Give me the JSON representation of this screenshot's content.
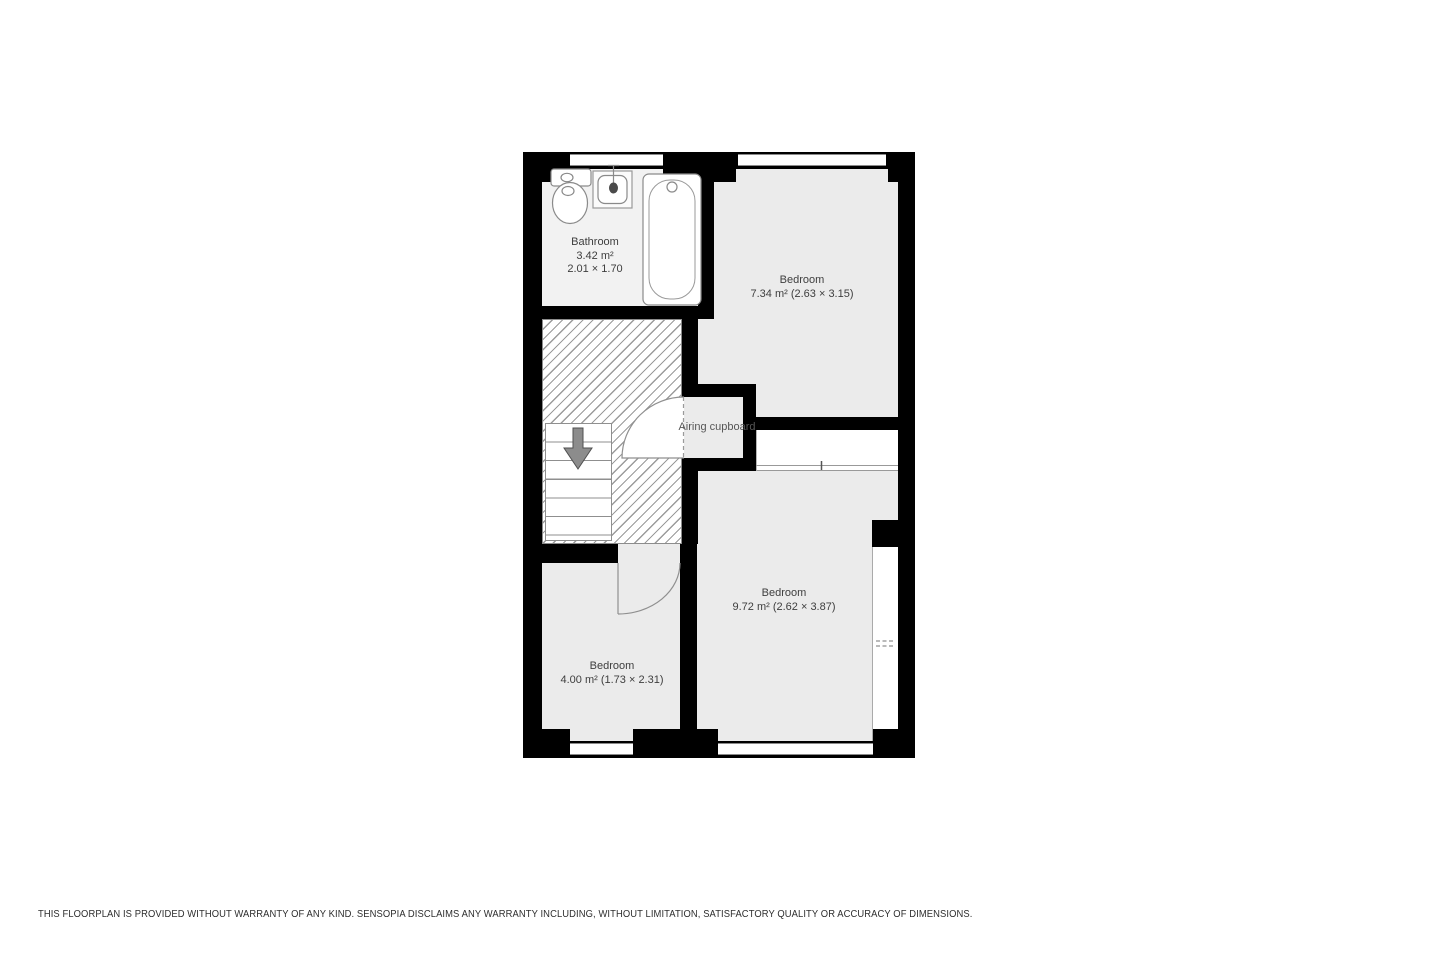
{
  "floorplan": {
    "rooms": {
      "bathroom": {
        "name": "Bathroom",
        "area": "3.42 m²",
        "dims": "2.01 × 1.70"
      },
      "bedroom_top": {
        "name": "Bedroom",
        "details": "7.34 m² (2.63 × 3.15)"
      },
      "bedroom_right": {
        "name": "Bedroom",
        "details": "9.72 m² (2.62 × 3.87)"
      },
      "bedroom_left": {
        "name": "Bedroom",
        "details": "4.00 m² (1.73 × 2.31)"
      },
      "airing_cupboard": {
        "name": "Airing cupboard"
      }
    },
    "fixtures": [
      "toilet",
      "sink",
      "bathtub",
      "staircase-down-arrow"
    ],
    "colors": {
      "wall": "#000000",
      "room_fill": "#ebebeb",
      "bathroom_fill": "#f2f2f2",
      "hatch_line": "#9b9b9b",
      "label_text": "#3e3e3e",
      "fixture_outline": "#8a8a8a",
      "stairs_arrow": "#8c8c8c"
    }
  },
  "footer": {
    "disclaimer": "THIS FLOORPLAN IS PROVIDED WITHOUT WARRANTY OF ANY KIND. SENSOPIA DISCLAIMS ANY WARRANTY INCLUDING, WITHOUT LIMITATION, SATISFACTORY QUALITY OR ACCURACY OF DIMENSIONS."
  }
}
